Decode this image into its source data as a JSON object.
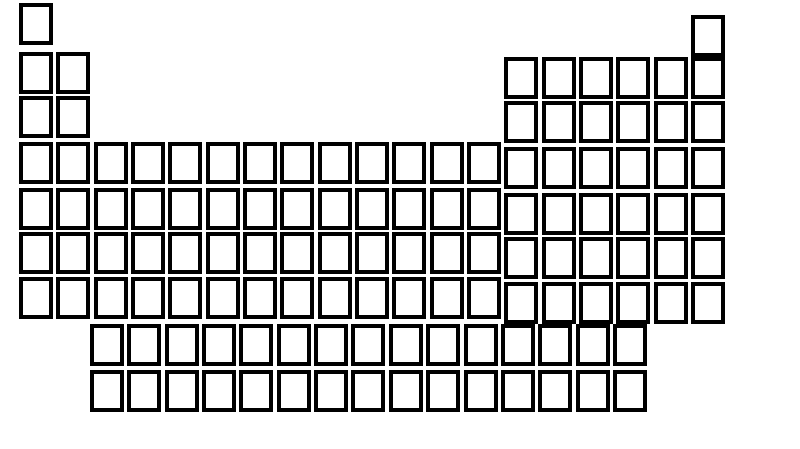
{
  "figure": {
    "description": "Blank periodic table of the elements template with empty boxes and no labels",
    "background_color": "#ffffff",
    "cell_border_color": "#000000",
    "cell_fill_color": "#ffffff",
    "all_cells_empty": true,
    "main_grid": {
      "column_count": 19,
      "period_count": 7,
      "total_cells": 94,
      "periods": [
        {
          "period": 1,
          "cell_count": 2,
          "cell_column_spans": [
            [
              1,
              1
            ],
            [
              19,
              19
            ]
          ]
        },
        {
          "period": 2,
          "cell_count": 8,
          "cell_column_spans": [
            [
              1,
              2
            ],
            [
              14,
              19
            ]
          ]
        },
        {
          "period": 3,
          "cell_count": 8,
          "cell_column_spans": [
            [
              1,
              2
            ],
            [
              14,
              19
            ]
          ]
        },
        {
          "period": 4,
          "cell_count": 19,
          "cell_column_spans": [
            [
              1,
              19
            ]
          ]
        },
        {
          "period": 5,
          "cell_count": 19,
          "cell_column_spans": [
            [
              1,
              19
            ]
          ]
        },
        {
          "period": 6,
          "cell_count": 19,
          "cell_column_spans": [
            [
              1,
              19
            ]
          ]
        },
        {
          "period": 7,
          "cell_count": 19,
          "cell_column_spans": [
            [
              1,
              19
            ]
          ]
        }
      ]
    },
    "series_block": {
      "row_count": 2,
      "cells_per_row": 15,
      "total_cells": 30
    }
  }
}
